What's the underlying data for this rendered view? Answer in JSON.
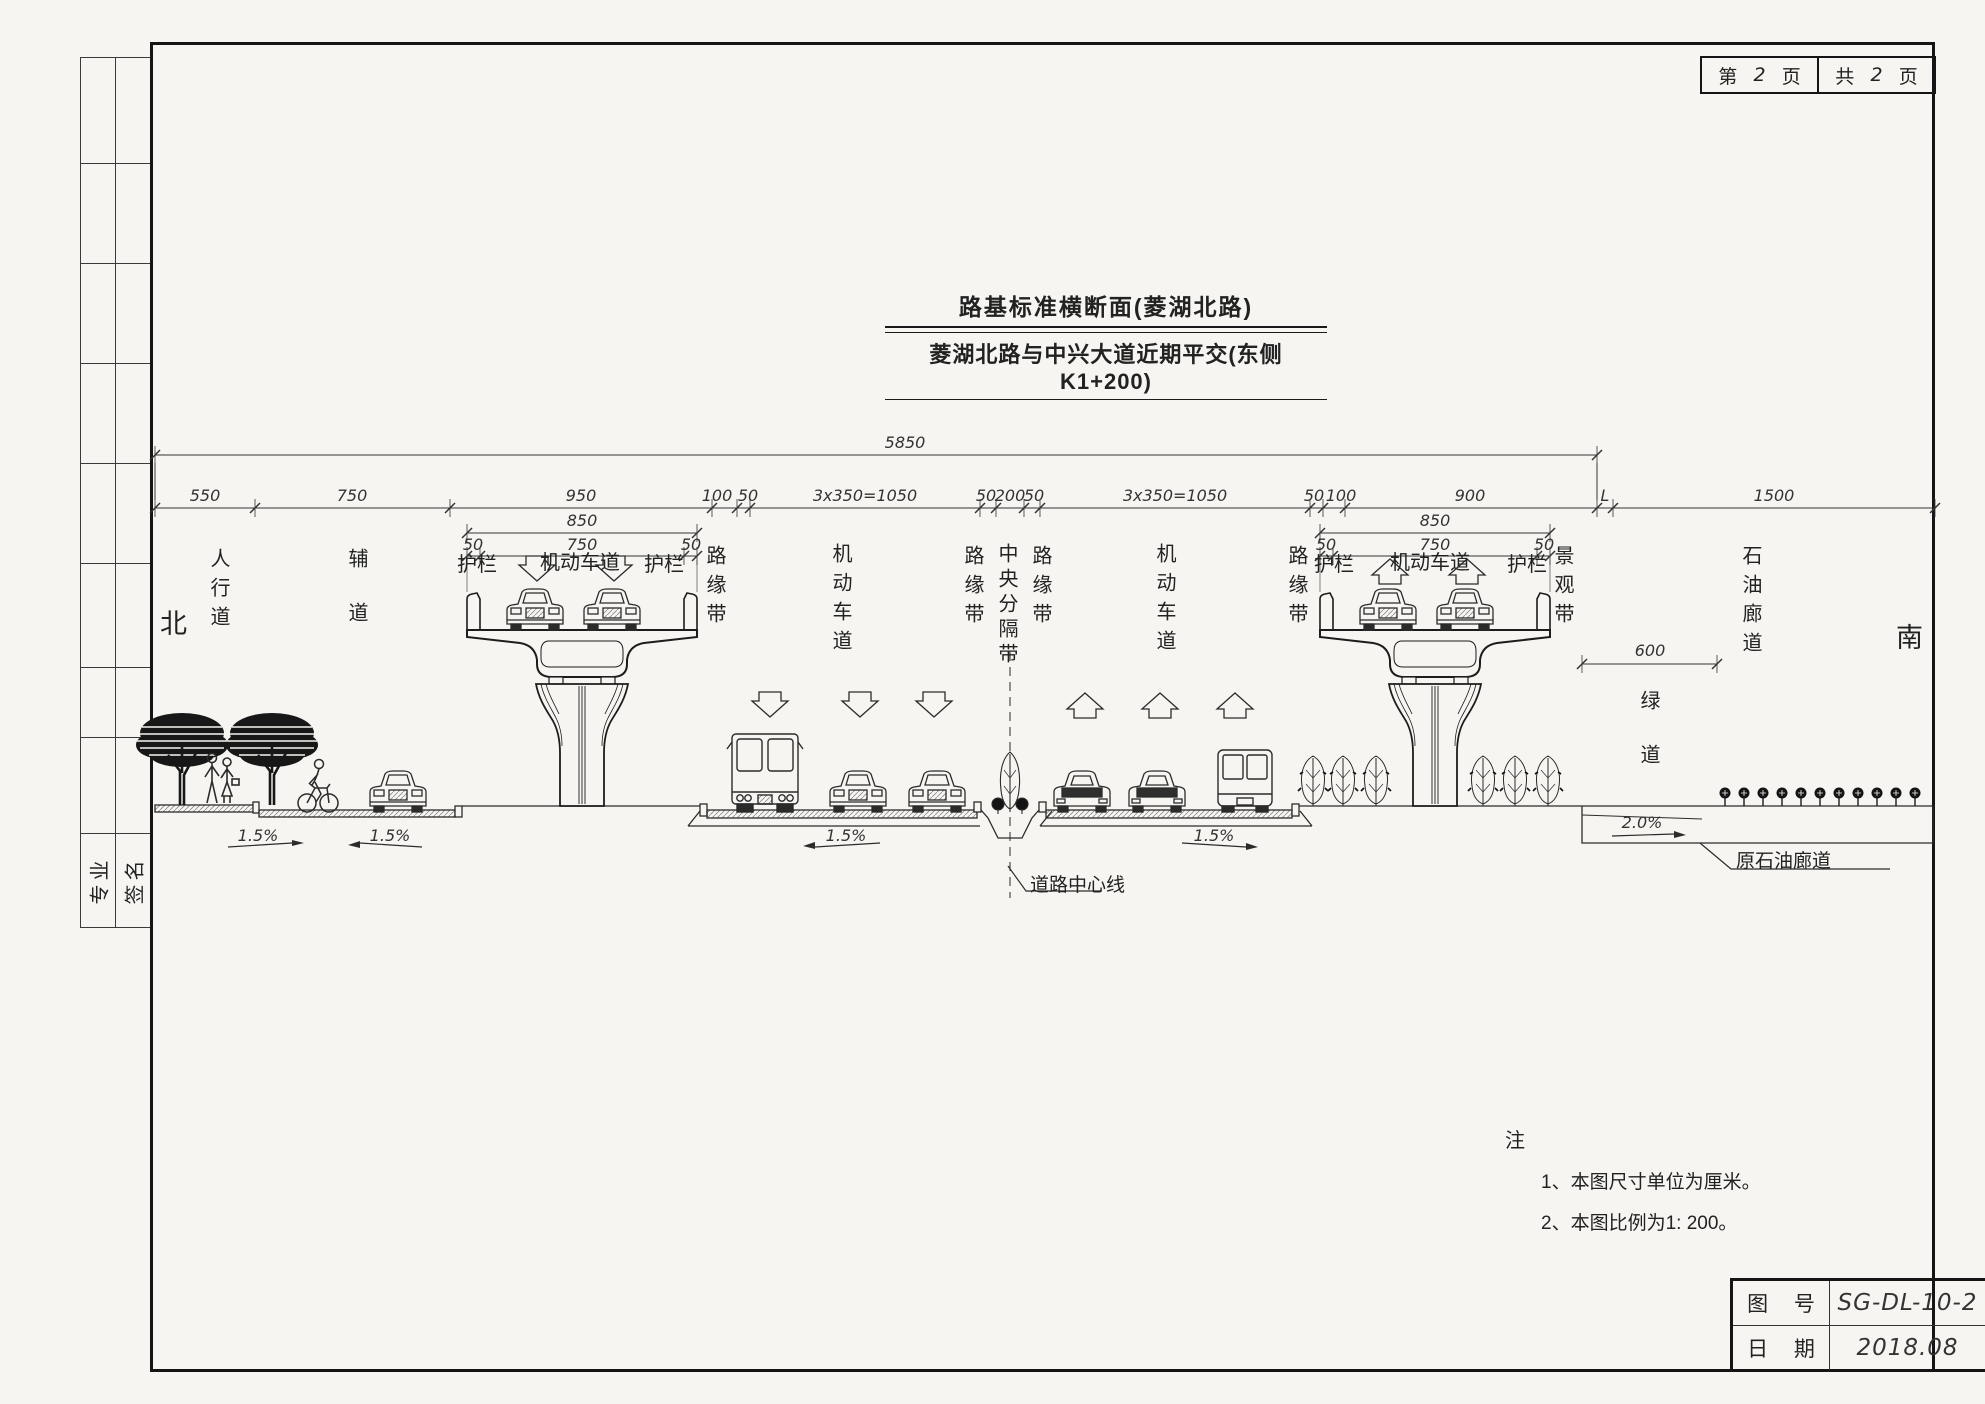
{
  "page_meta": {
    "sheet": {
      "prefix": "第",
      "num": "2",
      "suffix": "页"
    },
    "total": {
      "prefix": "共",
      "num": "2",
      "suffix": "页"
    }
  },
  "titles": {
    "main": "路基标准横断面(菱湖北路)",
    "sub": "菱湖北路与中兴大道近期平交(东侧K1+200)"
  },
  "compass": {
    "north": "北",
    "south": "南"
  },
  "dims": {
    "total": "5850",
    "segments": [
      "550",
      "750",
      "950",
      "100",
      "50",
      "3x350=1050",
      "50",
      "200",
      "50",
      "3x350=1050",
      "50",
      "100",
      "900",
      "L",
      "1500"
    ],
    "bridge": {
      "deck": "850",
      "edge_l": "50",
      "lane": "750",
      "edge_r": "50"
    },
    "greenway": "600"
  },
  "zones": {
    "sidewalk": "人行道",
    "aux": "辅道",
    "median": "中央分隔带",
    "scenic": "景观带",
    "oil": "石油廊道",
    "green": "绿道",
    "rails": [
      "护栏",
      "护栏",
      "护栏",
      "护栏"
    ],
    "motor": [
      "机动车道",
      "机动车道",
      "机动车道",
      "机动车道"
    ],
    "edges": [
      "路缘带",
      "路缘带",
      "路缘带",
      "路缘带"
    ]
  },
  "slopes": [
    "1.5%",
    "1.5%",
    "1.5%",
    "1.5%",
    "2.0%"
  ],
  "callouts": {
    "centerline": "道路中心线",
    "old_oil_corridor": "原石油廊道"
  },
  "notes": {
    "header": "注",
    "item1": "1、本图尺寸单位为厘米。",
    "item2": "2、本图比例为1: 200。"
  },
  "title_block": {
    "fig_no_label": "图 号",
    "fig_no": "SG-DL-10-2",
    "date_label": "日 期",
    "date": "2018.08"
  },
  "margin": {
    "col1": "专业",
    "col2": "签名"
  }
}
